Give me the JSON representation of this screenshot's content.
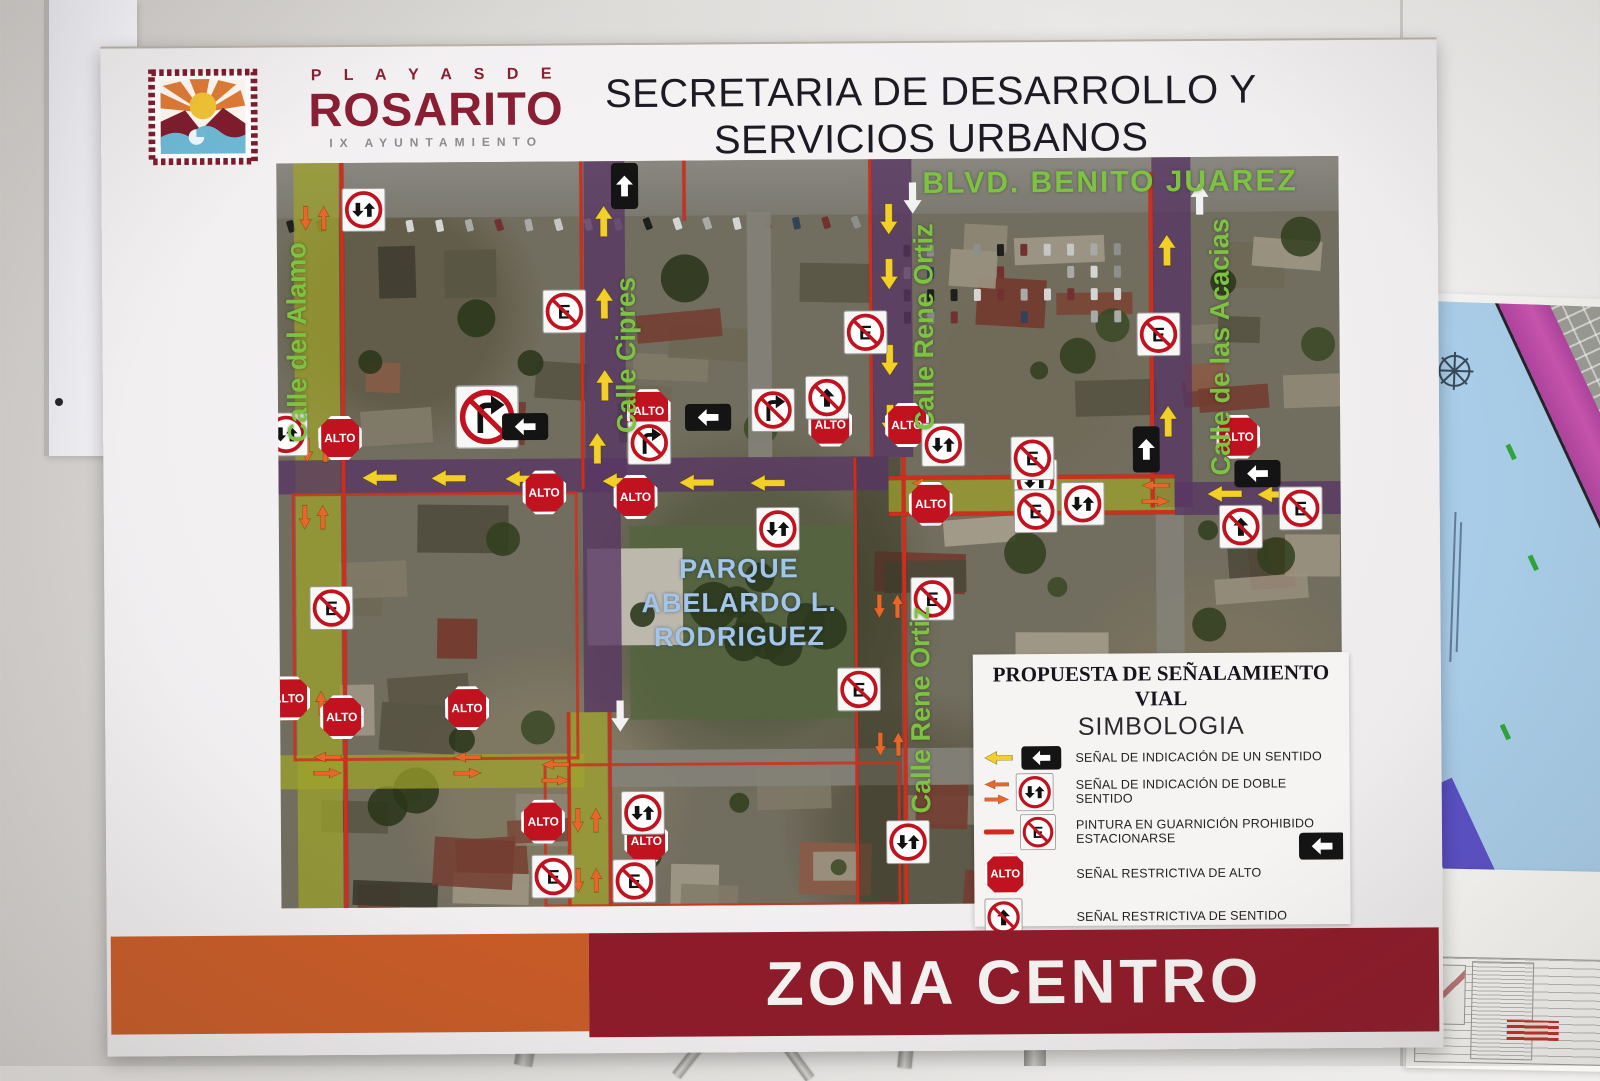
{
  "header": {
    "brand_top": "P L A Y A S   D E",
    "brand_name": "ROSARITO",
    "brand_sub": "IX AYUNTAMIENTO",
    "title_line1": "SECRETARIA DE DESARROLLO Y",
    "title_line2": "SERVICIOS URBANOS"
  },
  "banner": {
    "text": "ZONA CENTRO"
  },
  "legend": {
    "title": "PROPUESTA DE SEÑALAMIENTO VIAL",
    "subtitle": "SIMBOLOGIA",
    "items": [
      {
        "icon": "one-way",
        "label": "SEÑAL DE INDICACIÓN DE UN SENTIDO"
      },
      {
        "icon": "two-way",
        "label": "SEÑAL DE INDICACIÓN DE DOBLE SENTIDO"
      },
      {
        "icon": "no-parking",
        "label": "PINTURA EN GUARNICIÓN PROHIBIDO ESTACIONARSE"
      },
      {
        "icon": "stop",
        "label": "SEÑAL RESTRICTIVA  DE ALTO"
      },
      {
        "icon": "no-entry",
        "label": "SEÑAL RESTRICTIVA DE SENTIDO"
      },
      {
        "icon": "no-left-turn",
        "label": "SEÑAL PROHIBIDO VUELTA IZQUIERDA"
      }
    ]
  },
  "map": {
    "stop_text": "ALTO",
    "park_label": [
      "PARQUE",
      "ABELARDO  L.",
      "RODRIGUEZ"
    ],
    "street_labels": [
      {
        "text": "BLVD. BENITO JUAREZ",
        "x": 78.5,
        "y": 3.4,
        "v": false,
        "size": 30
      },
      {
        "text": "Calle del Alamo",
        "x": 1.9,
        "y": 24,
        "v": true,
        "size": 27
      },
      {
        "text": "Calle Cipres",
        "x": 32.9,
        "y": 26,
        "v": true,
        "size": 27
      },
      {
        "text": "Calle Rene Ortiz",
        "x": 60.9,
        "y": 22.5,
        "v": true,
        "size": 27
      },
      {
        "text": "Calle Rene Ortiz",
        "x": 60.4,
        "y": 74,
        "v": true,
        "size": 27
      },
      {
        "text": "Calle de las Acacias",
        "x": 88.8,
        "y": 25.5,
        "v": true,
        "size": 27
      }
    ],
    "signs": [
      {
        "t": "alto",
        "x": 5.8,
        "y": 36.9
      },
      {
        "t": "alto",
        "x": 25.0,
        "y": 44.4
      },
      {
        "t": "alto",
        "x": 34.9,
        "y": 33.6
      },
      {
        "t": "alto",
        "x": 33.6,
        "y": 45.1
      },
      {
        "t": "alto",
        "x": 52.0,
        "y": 35.6
      },
      {
        "t": "alto",
        "x": 59.2,
        "y": 35.7
      },
      {
        "t": "alto",
        "x": 90.4,
        "y": 37.6
      },
      {
        "t": "alto",
        "x": 61.4,
        "y": 46.3
      },
      {
        "t": "alto",
        "x": 0.8,
        "y": 71.8
      },
      {
        "t": "alto",
        "x": 5.8,
        "y": 74.4
      },
      {
        "t": "alto",
        "x": 17.6,
        "y": 73.3
      },
      {
        "t": "alto",
        "x": 24.7,
        "y": 88.6
      },
      {
        "t": "alto",
        "x": 34.4,
        "y": 91.3
      },
      {
        "t": "tw",
        "x": 8.2,
        "y": 6.3
      },
      {
        "t": "tw",
        "x": 0.8,
        "y": 36.4
      },
      {
        "t": "tw",
        "x": 62.6,
        "y": 38.4
      },
      {
        "t": "tw",
        "x": 71.3,
        "y": 43.4
      },
      {
        "t": "tw",
        "x": 75.7,
        "y": 46.4
      },
      {
        "t": "tw",
        "x": 47.0,
        "y": 49.5
      },
      {
        "t": "tw",
        "x": 34.1,
        "y": 87.5
      },
      {
        "t": "tw",
        "x": 59.0,
        "y": 91.7
      },
      {
        "t": "np",
        "x": 27.0,
        "y": 20.1
      },
      {
        "t": "np",
        "x": 55.4,
        "y": 23.2
      },
      {
        "t": "np",
        "x": 83.0,
        "y": 23.7
      },
      {
        "t": "np",
        "x": 71.0,
        "y": 40.3
      },
      {
        "t": "np",
        "x": 71.3,
        "y": 47.4
      },
      {
        "t": "np",
        "x": 96.2,
        "y": 47.2
      },
      {
        "t": "np",
        "x": 61.5,
        "y": 59.1
      },
      {
        "t": "np",
        "x": 54.5,
        "y": 71.1
      },
      {
        "t": "np",
        "x": 4.9,
        "y": 59.7
      },
      {
        "t": "np",
        "x": 25.6,
        "y": 96.0
      },
      {
        "t": "np",
        "x": 33.2,
        "y": 96.6
      },
      {
        "t": "nrt",
        "x": 19.7,
        "y": 34.2,
        "s": 1.45
      },
      {
        "t": "nrt",
        "x": 34.9,
        "y": 37.8
      },
      {
        "t": "nrt",
        "x": 46.6,
        "y": 33.6
      },
      {
        "t": "ne",
        "x": 51.7,
        "y": 31.9
      },
      {
        "t": "ne",
        "x": 90.6,
        "y": 49.7
      },
      {
        "t": "owl",
        "x": 23.3,
        "y": 35.6
      },
      {
        "t": "owl",
        "x": 40.5,
        "y": 34.5
      },
      {
        "t": "owl",
        "x": 92.2,
        "y": 42.6
      },
      {
        "t": "owl",
        "x": 98.0,
        "y": 92.6
      },
      {
        "t": "owu",
        "x": 32.8,
        "y": 3.4
      },
      {
        "t": "owu",
        "x": 81.7,
        "y": 39.2
      }
    ],
    "arrows": [
      {
        "d": "up",
        "c": "y",
        "x": 30.8,
        "y": 8
      },
      {
        "d": "up",
        "c": "y",
        "x": 30.8,
        "y": 19
      },
      {
        "d": "up",
        "c": "y",
        "x": 30.8,
        "y": 30
      },
      {
        "d": "up",
        "c": "y",
        "x": 30.0,
        "y": 38.5
      },
      {
        "d": "up",
        "c": "y",
        "x": 83.8,
        "y": 12.5
      },
      {
        "d": "up",
        "c": "y",
        "x": 83.8,
        "y": 23
      },
      {
        "d": "up",
        "c": "y",
        "x": 83.8,
        "y": 35.5
      },
      {
        "d": "down",
        "c": "y",
        "x": 57.6,
        "y": 8
      },
      {
        "d": "down",
        "c": "y",
        "x": 57.6,
        "y": 15.5
      },
      {
        "d": "down",
        "c": "y",
        "x": 57.6,
        "y": 27
      },
      {
        "d": "down",
        "c": "y",
        "x": 57.6,
        "y": 35
      },
      {
        "d": "left",
        "c": "y",
        "x": 9.5,
        "y": 42.3
      },
      {
        "d": "left",
        "c": "y",
        "x": 16,
        "y": 42.4
      },
      {
        "d": "left",
        "c": "y",
        "x": 23,
        "y": 42.6
      },
      {
        "d": "left",
        "c": "y",
        "x": 32.1,
        "y": 42.9
      },
      {
        "d": "left",
        "c": "y",
        "x": 39.4,
        "y": 43.2
      },
      {
        "d": "left",
        "c": "y",
        "x": 46,
        "y": 43.4
      },
      {
        "d": "left",
        "c": "y",
        "x": 89.1,
        "y": 45.2
      },
      {
        "d": "left",
        "c": "y",
        "x": 93.8,
        "y": 45.4
      },
      {
        "d": "down",
        "c": "w",
        "x": 59.9,
        "y": 5.2
      },
      {
        "d": "up",
        "c": "w",
        "x": 86.9,
        "y": 5.6
      },
      {
        "d": "down",
        "c": "w",
        "x": 32.0,
        "y": 74.5
      }
    ],
    "orange_pairs_v": [
      [
        3.6,
        7.4
      ],
      [
        3.6,
        38.5
      ],
      [
        3.3,
        47.5
      ],
      [
        3.0,
        72.5
      ],
      [
        28.8,
        88.5
      ],
      [
        28.8,
        96.5
      ],
      [
        57.3,
        60
      ],
      [
        57.3,
        78.5
      ]
    ],
    "orange_pairs_h": [
      [
        4.4,
        80.8
      ],
      [
        17.6,
        81.0
      ],
      [
        25.9,
        82.0
      ],
      [
        60.9,
        44.6
      ],
      [
        71.0,
        44.8
      ],
      [
        82.6,
        45.1
      ]
    ]
  },
  "colors": {
    "brand_red": "#8a1e32",
    "band_orange": "#c75b28",
    "band_red": "#8e1b2a",
    "street_green_label": "#7ec242",
    "park_blue_label": "#a3c6e8",
    "highlight_yellow": "#adb22c",
    "highlight_purple": "#5e376c",
    "arrow_yellow": "#f2d029",
    "arrow_orange": "#e8662a",
    "sign_red": "#c1121f"
  }
}
